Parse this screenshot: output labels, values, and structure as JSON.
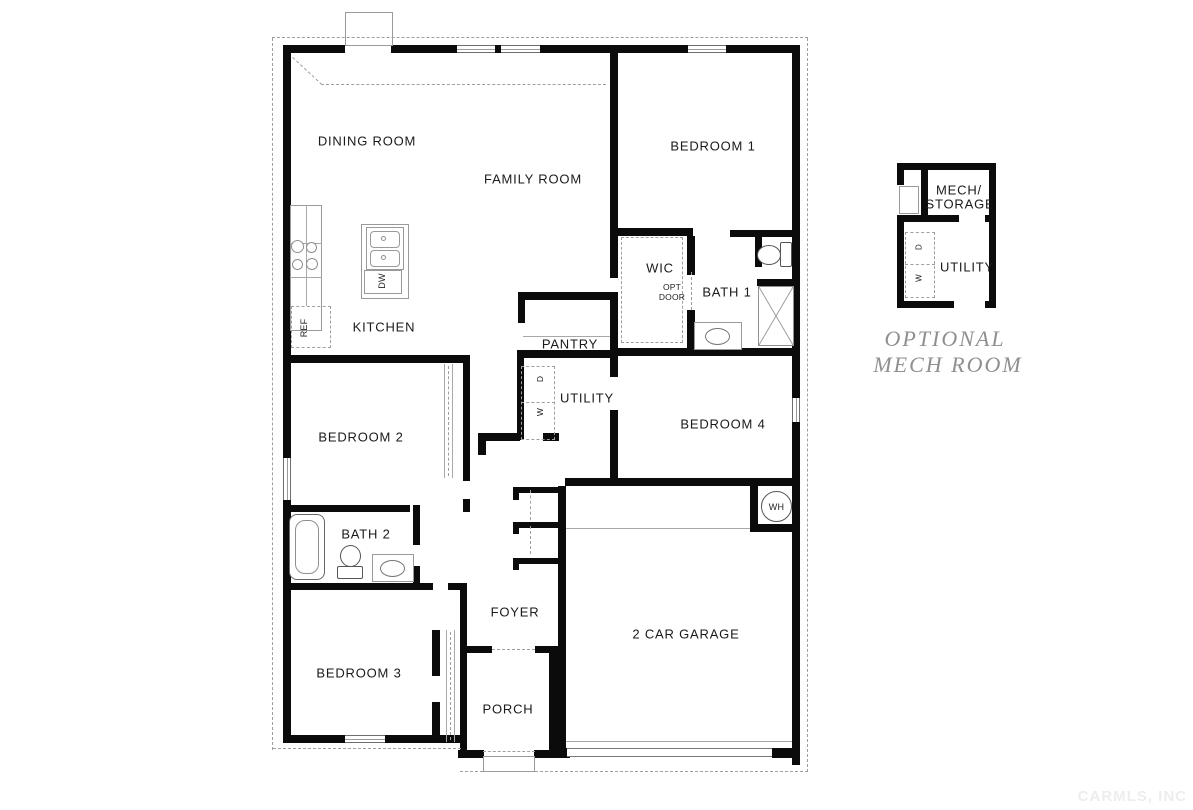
{
  "plan": {
    "rooms": {
      "dining_room": "DINING ROOM",
      "family_room": "FAMILY ROOM",
      "bedroom_1": "BEDROOM 1",
      "kitchen": "KITCHEN",
      "wic": "WIC",
      "bath_1": "BATH 1",
      "pantry": "PANTRY",
      "utility": "UTILITY",
      "bedroom_4": "BEDROOM 4",
      "bedroom_2": "BEDROOM 2",
      "bath_2": "BATH 2",
      "bedroom_3": "BEDROOM 3",
      "foyer": "FOYER",
      "porch": "PORCH",
      "garage": "2 CAR GARAGE"
    },
    "fixtures": {
      "opt_door_line_1": "OPT",
      "opt_door_line_2": "DOOR",
      "refrigerator": "REF",
      "dishwasher": "DW",
      "washer": "W",
      "dryer": "D",
      "water_heater": "WH"
    }
  },
  "inset": {
    "rooms": {
      "mech_storage_line_1": "MECH/",
      "mech_storage_line_2": "STORAGE",
      "utility": "UTILITY"
    },
    "fixtures": {
      "washer": "W",
      "dryer": "D"
    },
    "caption_line_1": "OPTIONAL",
    "caption_line_2": "MECH ROOM"
  },
  "watermark": "CARMLS, INC",
  "colors": {
    "wall": "#0b0b0b",
    "label": "#1a1a1a",
    "fixture_line": "#9a9a9a",
    "caption": "#8f8f8f",
    "watermark": "#ededed",
    "background": "#ffffff"
  }
}
